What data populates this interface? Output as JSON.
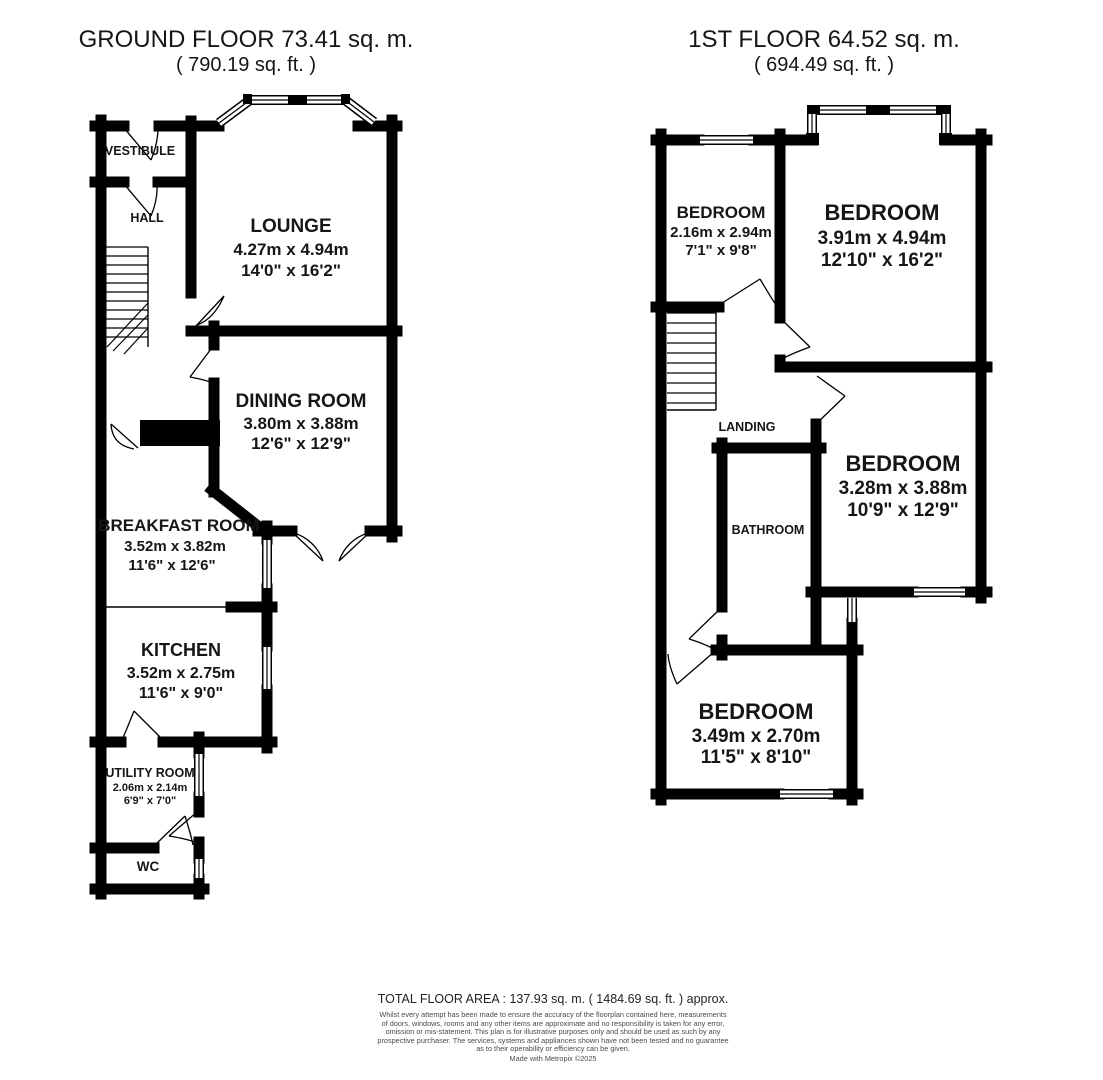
{
  "meta": {
    "background_color": "#ffffff",
    "wall_color": "#000000",
    "text_color": "#161616",
    "disclaimer_color": "#4a4a4a"
  },
  "ground_floor": {
    "title": "GROUND FLOOR 73.41 sq. m.",
    "subtitle": "( 790.19 sq. ft. )",
    "rooms": {
      "vestibule": {
        "name": "VESTIBULE"
      },
      "hall": {
        "name": "HALL"
      },
      "lounge": {
        "name": "LOUNGE",
        "metric": "4.27m x 4.94m",
        "imperial": "14'0\" x 16'2\""
      },
      "dining": {
        "name": "DINING ROOM",
        "metric": "3.80m x 3.88m",
        "imperial": "12'6\" x 12'9\""
      },
      "breakfast": {
        "name": "BREAKFAST ROOM",
        "metric": "3.52m x 3.82m",
        "imperial": "11'6\" x 12'6\""
      },
      "kitchen": {
        "name": "KITCHEN",
        "metric": "3.52m x 2.75m",
        "imperial": "11'6\" x 9'0\""
      },
      "utility": {
        "name": "UTILITY ROOM",
        "metric": "2.06m x 2.14m",
        "imperial": "6'9\" x 7'0\""
      },
      "wc": {
        "name": "WC"
      }
    }
  },
  "first_floor": {
    "title": "1ST FLOOR 64.52 sq. m.",
    "subtitle": "( 694.49 sq. ft. )",
    "rooms": {
      "bedroom_front_small": {
        "name": "BEDROOM",
        "metric": "2.16m x 2.94m",
        "imperial": "7'1\" x 9'8\""
      },
      "bedroom_front_large": {
        "name": "BEDROOM",
        "metric": "3.91m x 4.94m",
        "imperial": "12'10\" x 16'2\""
      },
      "bedroom_middle": {
        "name": "BEDROOM",
        "metric": "3.28m x 3.88m",
        "imperial": "10'9\" x 12'9\""
      },
      "bedroom_rear": {
        "name": "BEDROOM",
        "metric": "3.49m x 2.70m",
        "imperial": "11'5\" x 8'10\""
      },
      "landing": {
        "name": "LANDING"
      },
      "bathroom": {
        "name": "BATHROOM"
      }
    }
  },
  "footer": {
    "total_area": "TOTAL FLOOR AREA : 137.93 sq. m. ( 1484.69 sq. ft. ) approx.",
    "disclaimer_lines": [
      "Whilst every attempt has been made to ensure the accuracy of the floorplan contained here, measurements",
      "of doors, windows, rooms and any other items are approximate and no responsibility is taken for any error,",
      "omission or mis-statement. This plan is for illustrative purposes only and should be used as such by any",
      "prospective purchaser. The services, systems and appliances shown have not been tested and no guarantee",
      "as to their operability or efficiency can be given."
    ],
    "credit": "Made with Metropix ©2025"
  }
}
